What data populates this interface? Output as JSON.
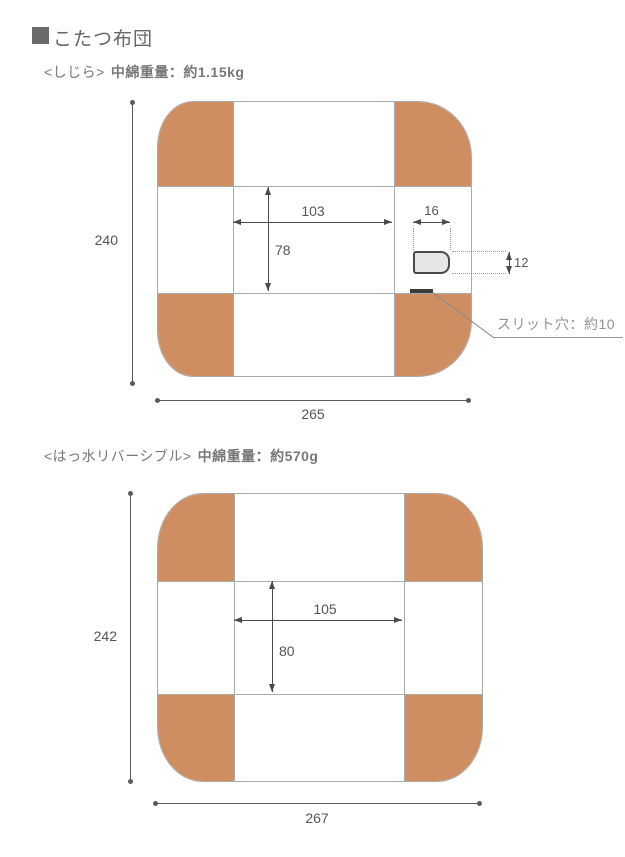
{
  "header": {
    "title": "こたつ布団"
  },
  "sections": [
    {
      "fabric_label": "<しじら>",
      "fill_weight": "中綿重量：約1.15kg",
      "dims": {
        "height": "240",
        "width": "265",
        "inner_width": "103",
        "inner_height": "78",
        "pocket_width": "16",
        "pocket_height": "12"
      },
      "slit_note": "スリット穴：約10"
    },
    {
      "fabric_label": "<はっ水リバーシブル>",
      "fill_weight": "中綿重量：約570g",
      "dims": {
        "height": "242",
        "width": "267",
        "inner_width": "105",
        "inner_height": "80"
      }
    }
  ],
  "colors": {
    "futon_orange": "#cf8d62",
    "grid_line": "#aaaaaa",
    "dimension_line": "#5a5a5a",
    "pocket_fill": "#e6e6e6",
    "pocket_border": "#4a4a4a",
    "header_square": "#6b6b6b"
  }
}
